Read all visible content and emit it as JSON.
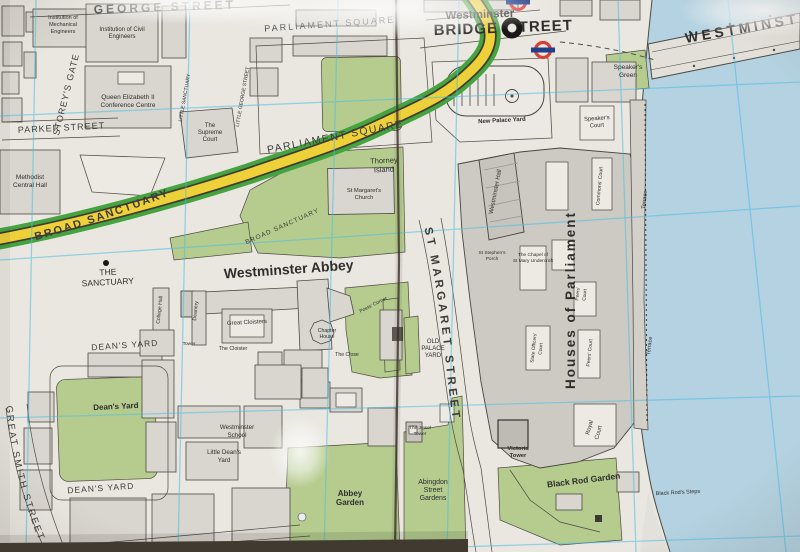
{
  "photo_subject": "street map of Westminster, London",
  "colors": {
    "paper": "#eeece7",
    "building": "#dcdad4",
    "building_dark": "#d0cec8",
    "green_space": "#b7d090",
    "water": "#b6d6e6",
    "grid_line": "#49c0e8",
    "route_yellow": "#f2d438",
    "route_green": "#43a63f",
    "roundel_red": "#dc3c36",
    "roundel_blue": "#1c3e8e",
    "fold_line": "#332d26"
  },
  "icons": {
    "underground_station": "underground-roundel",
    "station_entrance": "station-entrance-circle",
    "place_marker": "sanctuary-dot"
  },
  "labels": {
    "george_street": "GEORGE STREET",
    "parliament_square_upper": "PARLIAMENT SQUARE",
    "parliament_square": "PARLIAMENT SQUARE",
    "westminster_station": "Westminster",
    "bridge_street_a": "BRIDGE",
    "bridge_street_b": "TREET",
    "westminster_bridge": "WESTMINSTER BRIDGE",
    "speakers_green_1": "Speaker's",
    "speakers_green_2": "Green",
    "speakers_court_1": "Speaker's",
    "speakers_court_2": "Court",
    "storeys_gate": "STOREY'S GATE",
    "little_sanctuary": "LITTLE SANCTUARY",
    "little_george_street": "LITTLE GEORGE STREET",
    "inst_mech_1": "Institution of",
    "inst_mech_2": "Mechanical",
    "inst_mech_3": "Engineers",
    "inst_civil_1": "Institution of Civil",
    "inst_civil_2": "Engineers",
    "qeii_1": "Queen Elizabeth II",
    "qeii_2": "Conference Centre",
    "parker_street": "PARKER STREET",
    "supreme_1": "The",
    "supreme_2": "Supreme",
    "supreme_3": "Court",
    "methodist_1": "Methodist",
    "methodist_2": "Central Hall",
    "broad_sanctuary_main": "BROAD SANCTUARY",
    "broad_sanctuary_small": "BROAD SANCTUARY",
    "thorney_1": "Thorney",
    "thorney_2": "Island",
    "st_margarets_1": "St Margaret's",
    "st_margarets_2": "Church",
    "new_palace_yard": "New Palace Yard",
    "westminster_hall": "Westminster Hall",
    "commons_court": "Commons' Court",
    "houses_of_parliament": "Houses of Parliament",
    "terrace_n": "Terrace",
    "terrace_s": "Terrace",
    "the_sanctuary_1": "THE",
    "the_sanctuary_2": "SANCTUARY",
    "westminster_abbey": "Westminster Abbey",
    "college_hall": "College Hall",
    "deanery": "Deanery",
    "great_cloisters": "Great Cloisters",
    "the_cloister": "The Cloister",
    "tower": "Tower",
    "chapter_house_1": "Chapter",
    "chapter_house_2": "House",
    "the_close": "The Close",
    "poets_corner": "Poets' Corner",
    "old_palace_1": "OLD",
    "old_palace_2": "PALACE",
    "old_palace_3": "YARD",
    "st_margaret_street": "ST MARGARET STREET",
    "st_stephens_1": "St Stephen's",
    "st_stephens_2": "Porch",
    "chapel_1": "The Chapel of",
    "chapel_2": "St Mary Undercroft",
    "state_officers_1": "State Officers'",
    "state_officers_2": "Court",
    "peers_court_upper_1": "Peers'",
    "peers_court_upper_2": "Court",
    "peers_court": "Peers' Court",
    "royal_court_1": "Royal",
    "royal_court_2": "Court",
    "victoria_tower_1": "Victoria",
    "victoria_tower_2": "Tower",
    "black_rod_garden": "Black Rod Garden",
    "black_rod_steps": "Black Rod's Steps",
    "deans_yard_lawn": "Dean's Yard",
    "deans_yard_street_n": "DEAN'S YARD",
    "deans_yard_street_s": "DEAN'S YARD",
    "westminster_school_1": "Westminster",
    "westminster_school_2": "School",
    "little_deans_1": "Little Dean's",
    "little_deans_2": "Yard",
    "abbey_garden_1": "Abbey",
    "abbey_garden_2": "Garden",
    "abingdon_1": "Abingdon",
    "abingdon_2": "Street",
    "abingdon_3": "Gardens",
    "jewel_tower_1": "The Jewel",
    "jewel_tower_2": "Tower",
    "great_smith_street": "GREAT SMITH STREET",
    "great_college_street": "GREAT"
  }
}
